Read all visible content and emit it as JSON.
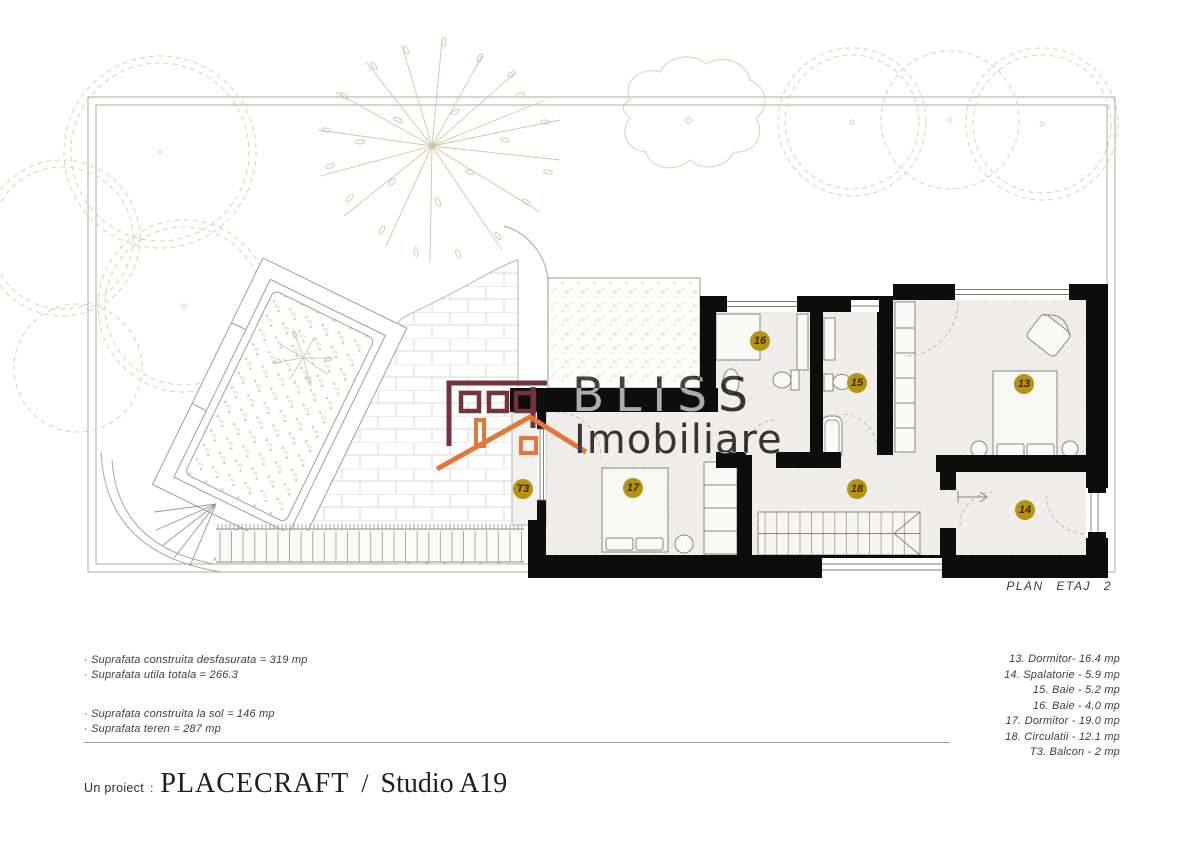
{
  "plan": {
    "label": "PLAN ETAJ 2",
    "watermark": {
      "line1": "BLISS",
      "line2": "Imobiliare"
    },
    "badges": {
      "b13": "13",
      "b14": "14",
      "b15": "15",
      "b16": "16",
      "b17": "17",
      "b18": "18",
      "bT3": "T3"
    }
  },
  "area_summary": {
    "line1": "· Suprafata construita desfasurata = 319 mp",
    "line2": "· Suprafata utila totala = 266.3",
    "line3": "· Suprafata construita la sol = 146 mp",
    "line4": "· Suprafata teren = 287 mp"
  },
  "room_legend": {
    "line1": "13. Dormitor- 16.4 mp",
    "line2": "14. Spalatorie - 5.9 mp",
    "line3": "15. Baie - 5.2 mp",
    "line4": "16. Baie - 4.0 mp",
    "line5": "17. Dormitor - 19.0 mp",
    "line6": "18. Circulatii - 12.1 mp",
    "line7": "T3. Balcon - 2 mp"
  },
  "footer": {
    "prefix": "Un proiect",
    "colon": ":",
    "brand": "PLACECRAFT",
    "slash": "/",
    "studio": "Studio A19"
  },
  "colors": {
    "badge_bg": "#b5950f",
    "badge_text": "#44230f",
    "wall": "#0d0d0d",
    "logo_maroon": "#73323c",
    "logo_orange": "#e4763c",
    "watermark_gray": "#4a4a4a",
    "line_gray": "#a8a69d",
    "tree_olive": "#d7d1b6"
  }
}
